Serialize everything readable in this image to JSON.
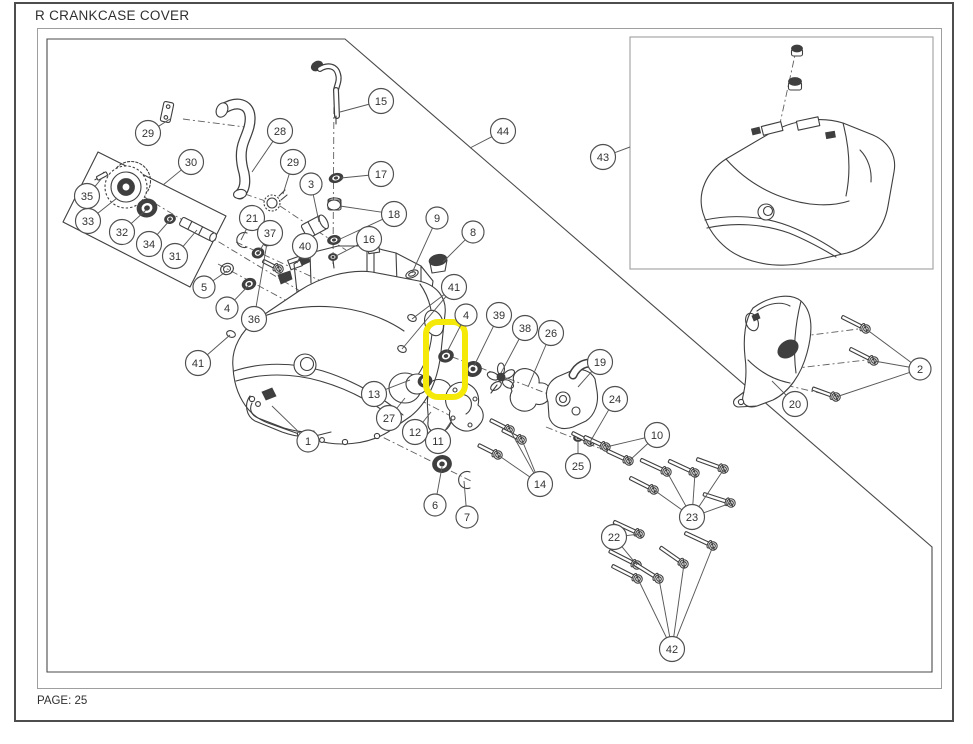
{
  "page": {
    "title": "R CRANKCASE COVER",
    "page_label": "PAGE: 25"
  },
  "colors": {
    "line": "#3f3f3f",
    "frame": "#9e9e9e",
    "border": "#4d4d4d",
    "leader": "#585858",
    "highlight": "#f5e90a",
    "text": "#2f2f2f",
    "background": "#ffffff"
  },
  "highlight": {
    "x": 426,
    "y": 322,
    "w": 39,
    "h": 75,
    "r": 12,
    "stroke_width": 6
  },
  "callouts": [
    {
      "n": "1",
      "x": 308,
      "y": 441,
      "leaders": [
        [
          272,
          406
        ]
      ]
    },
    {
      "n": "2",
      "x": 920,
      "y": 369,
      "leaders": [
        [
          866,
          329
        ],
        [
          874,
          361
        ],
        [
          836,
          397
        ]
      ]
    },
    {
      "n": "3",
      "x": 311,
      "y": 184,
      "leaders": [
        [
          319,
          222
        ]
      ]
    },
    {
      "n": "4",
      "x": 227,
      "y": 308,
      "leaders": [
        [
          249,
          285
        ]
      ]
    },
    {
      "n": "4",
      "x": 466,
      "y": 315,
      "leaders": [
        [
          447,
          352
        ]
      ]
    },
    {
      "n": "5",
      "x": 204,
      "y": 287,
      "leaders": [
        [
          227,
          271
        ]
      ]
    },
    {
      "n": "6",
      "x": 435,
      "y": 505,
      "leaders": [
        [
          442,
          467
        ]
      ]
    },
    {
      "n": "7",
      "x": 467,
      "y": 517,
      "leaders": [
        [
          464,
          481
        ]
      ]
    },
    {
      "n": "8",
      "x": 473,
      "y": 232,
      "leaders": [
        [
          443,
          262
        ]
      ]
    },
    {
      "n": "9",
      "x": 437,
      "y": 218,
      "leaders": [
        [
          412,
          273
        ]
      ]
    },
    {
      "n": "10",
      "x": 657,
      "y": 435,
      "leaders": [
        [
          606,
          447
        ],
        [
          629,
          461
        ]
      ]
    },
    {
      "n": "11",
      "x": 438,
      "y": 441,
      "leaders": [
        [
          452,
          420
        ]
      ]
    },
    {
      "n": "12",
      "x": 415,
      "y": 432,
      "leaders": [
        [
          431,
          412
        ]
      ]
    },
    {
      "n": "13",
      "x": 374,
      "y": 394,
      "leaders": [
        [
          410,
          380
        ]
      ]
    },
    {
      "n": "14",
      "x": 540,
      "y": 484,
      "leaders": [
        [
          510,
          430
        ],
        [
          522,
          440
        ],
        [
          498,
          455
        ]
      ]
    },
    {
      "n": "15",
      "x": 381,
      "y": 101,
      "leaders": [
        [
          340,
          112
        ]
      ]
    },
    {
      "n": "16",
      "x": 369,
      "y": 239,
      "leaders": [
        [
          336,
          256
        ]
      ]
    },
    {
      "n": "17",
      "x": 381,
      "y": 174,
      "leaders": [
        [
          341,
          178
        ]
      ]
    },
    {
      "n": "18",
      "x": 394,
      "y": 214,
      "leaders": [
        [
          340,
          206
        ],
        [
          338,
          240
        ]
      ]
    },
    {
      "n": "19",
      "x": 600,
      "y": 362,
      "leaders": [
        [
          578,
          387
        ]
      ]
    },
    {
      "n": "20",
      "x": 795,
      "y": 404,
      "leaders": [
        [
          772,
          381
        ]
      ]
    },
    {
      "n": "21",
      "x": 252,
      "y": 218,
      "leaders": [
        [
          241,
          240
        ]
      ]
    },
    {
      "n": "22",
      "x": 614,
      "y": 537,
      "leaders": [
        [
          640,
          534
        ],
        [
          637,
          565
        ]
      ]
    },
    {
      "n": "23",
      "x": 692,
      "y": 517,
      "leaders": [
        [
          667,
          472
        ],
        [
          695,
          473
        ],
        [
          724,
          469
        ],
        [
          654,
          490
        ],
        [
          731,
          503
        ]
      ]
    },
    {
      "n": "24",
      "x": 615,
      "y": 399,
      "leaders": [
        [
          590,
          442
        ]
      ]
    },
    {
      "n": "25",
      "x": 578,
      "y": 466,
      "leaders": [
        [
          578,
          441
        ]
      ]
    },
    {
      "n": "26",
      "x": 551,
      "y": 333,
      "leaders": [
        [
          528,
          387
        ]
      ]
    },
    {
      "n": "27",
      "x": 389,
      "y": 418,
      "leaders": [
        [
          405,
          398
        ]
      ]
    },
    {
      "n": "28",
      "x": 280,
      "y": 131,
      "leaders": [
        [
          252,
          172
        ]
      ]
    },
    {
      "n": "29",
      "x": 148,
      "y": 133,
      "leaders": [
        [
          170,
          119
        ]
      ]
    },
    {
      "n": "29",
      "x": 293,
      "y": 162,
      "leaders": [
        [
          283,
          194
        ]
      ]
    },
    {
      "n": "30",
      "x": 191,
      "y": 162,
      "leaders": [
        [
          163,
          185
        ]
      ]
    },
    {
      "n": "31",
      "x": 175,
      "y": 256,
      "leaders": [
        [
          197,
          230
        ]
      ]
    },
    {
      "n": "32",
      "x": 122,
      "y": 232,
      "leaders": [
        [
          146,
          210
        ]
      ]
    },
    {
      "n": "33",
      "x": 88,
      "y": 221,
      "leaders": [
        [
          117,
          198
        ]
      ]
    },
    {
      "n": "34",
      "x": 149,
      "y": 244,
      "leaders": [
        [
          170,
          220
        ]
      ]
    },
    {
      "n": "35",
      "x": 87,
      "y": 196,
      "leaders": [
        [
          102,
          178
        ]
      ]
    },
    {
      "n": "36",
      "x": 254,
      "y": 319,
      "leaders": [
        [
          267,
          243
        ]
      ]
    },
    {
      "n": "37",
      "x": 270,
      "y": 233,
      "leaders": [
        [
          259,
          252
        ]
      ]
    },
    {
      "n": "38",
      "x": 525,
      "y": 328,
      "leaders": [
        [
          501,
          373
        ]
      ]
    },
    {
      "n": "39",
      "x": 499,
      "y": 315,
      "leaders": [
        [
          474,
          366
        ]
      ]
    },
    {
      "n": "40",
      "x": 305,
      "y": 246,
      "leaders": [
        [
          297,
          263
        ]
      ]
    },
    {
      "n": "41",
      "x": 198,
      "y": 363,
      "leaders": [
        [
          230,
          335
        ]
      ]
    },
    {
      "n": "41",
      "x": 454,
      "y": 287,
      "leaders": [
        [
          412,
          319
        ],
        [
          402,
          349
        ]
      ]
    },
    {
      "n": "42",
      "x": 672,
      "y": 649,
      "leaders": [
        [
          638,
          579
        ],
        [
          659,
          579
        ],
        [
          684,
          564
        ],
        [
          713,
          546
        ]
      ]
    },
    {
      "n": "43",
      "x": 603,
      "y": 157,
      "leaders": [
        [
          630,
          147
        ]
      ]
    },
    {
      "n": "44",
      "x": 503,
      "y": 131,
      "leaders": [
        [
          470,
          148
        ]
      ]
    }
  ],
  "bolts": [
    [
      279,
      269,
      13,
      27
    ],
    [
      510,
      430,
      17,
      27
    ],
    [
      522,
      440,
      17,
      27
    ],
    [
      498,
      455,
      17,
      27
    ],
    [
      590,
      442,
      15,
      27
    ],
    [
      606,
      447,
      19,
      25
    ],
    [
      629,
      461,
      19,
      25
    ],
    [
      667,
      472,
      24,
      25
    ],
    [
      695,
      473,
      24,
      25
    ],
    [
      724,
      469,
      24,
      20
    ],
    [
      654,
      490,
      22,
      27
    ],
    [
      731,
      503,
      24,
      18
    ],
    [
      640,
      534,
      24,
      25
    ],
    [
      637,
      565,
      26,
      27
    ],
    [
      638,
      579,
      24,
      27
    ],
    [
      659,
      579,
      24,
      32
    ],
    [
      684,
      564,
      24,
      35
    ],
    [
      713,
      546,
      26,
      25
    ],
    [
      866,
      329,
      22,
      27
    ],
    [
      874,
      361,
      22,
      27
    ],
    [
      836,
      397,
      20,
      20
    ]
  ],
  "rings": [
    [
      336,
      178,
      7,
      4.5,
      "dark",
      -15
    ],
    [
      334,
      205,
      6.5,
      5,
      "plain",
      0
    ],
    [
      334,
      240,
      6.5,
      4.5,
      "dark",
      -10
    ],
    [
      333,
      257,
      4.5,
      3.5,
      "dark",
      0
    ],
    [
      258,
      253,
      6,
      5,
      "dark",
      -20
    ],
    [
      227,
      269,
      6.5,
      5.5,
      "oring",
      -20
    ],
    [
      249,
      284,
      7,
      5.5,
      "dark",
      -20
    ],
    [
      267,
      242,
      4.5,
      4,
      "dark",
      0
    ],
    [
      231,
      334,
      4.5,
      3.2,
      "plain",
      20
    ],
    [
      412,
      318,
      4.5,
      3.2,
      "plain",
      25
    ],
    [
      402,
      349,
      4.5,
      3.2,
      "plain",
      25
    ],
    [
      446,
      356,
      7.5,
      6,
      "dark",
      -18
    ],
    [
      473,
      369,
      8.5,
      7.5,
      "dark",
      -15
    ],
    [
      425,
      381,
      7,
      6,
      "dark",
      -15
    ],
    [
      442,
      464,
      9.5,
      8.5,
      "dark",
      -12
    ],
    [
      578,
      438,
      4.5,
      3.5,
      "dark",
      0
    ],
    [
      412,
      274,
      6.5,
      3.5,
      "oring",
      -22
    ],
    [
      147,
      208,
      10,
      9,
      "dark",
      -15
    ],
    [
      170,
      219,
      5.5,
      4.5,
      "dark",
      -15
    ]
  ],
  "axes": [
    [
      103,
      172,
      300,
      291
    ],
    [
      218,
      264,
      300,
      308
    ],
    [
      236,
      242,
      332,
      286
    ],
    [
      245,
      194,
      280,
      206
    ],
    [
      280,
      206,
      346,
      250
    ],
    [
      334,
      92,
      333,
      266
    ],
    [
      183,
      119,
      245,
      127
    ],
    [
      424,
      346,
      574,
      404
    ],
    [
      393,
      386,
      470,
      426
    ],
    [
      330,
      411,
      473,
      482
    ],
    [
      546,
      427,
      604,
      450
    ],
    [
      797,
      46,
      779,
      128
    ],
    [
      772,
      382,
      833,
      396
    ],
    [
      757,
      342,
      858,
      329
    ],
    [
      763,
      372,
      866,
      360
    ],
    [
      406,
      321,
      378,
      340
    ],
    [
      397,
      352,
      370,
      369
    ]
  ]
}
